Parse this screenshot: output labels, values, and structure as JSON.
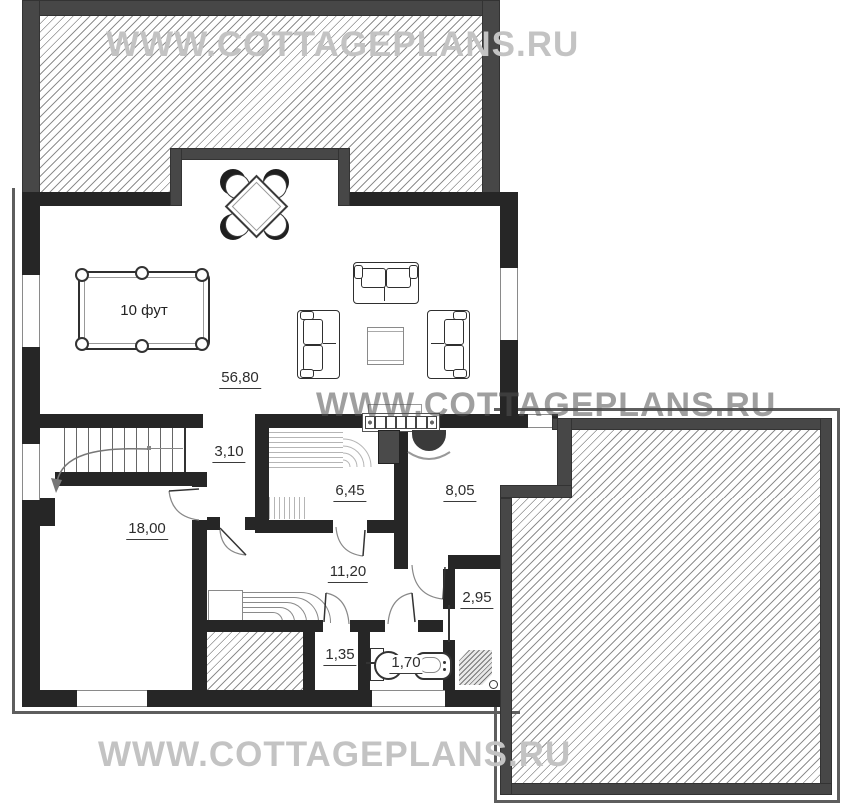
{
  "plan": {
    "watermark": "WWW.COTTAGEPLANS.RU",
    "rooms": {
      "living_room": "56,80",
      "stair_hall": "3,10",
      "sauna": "6,45",
      "fireplace_room": "8,05",
      "bedroom": "18,00",
      "hallway": "11,20",
      "shower_room": "2,95",
      "wc": "1,35",
      "bathroom": "1,70"
    },
    "billiard_table_label": "10 фут",
    "colors": {
      "outer_wall": "#474747",
      "inner_wall": "#262626",
      "hatch_line": "#8f8f8f",
      "watermark_light": "#c3c3c3",
      "watermark_dark": "#8a8a8a"
    }
  }
}
